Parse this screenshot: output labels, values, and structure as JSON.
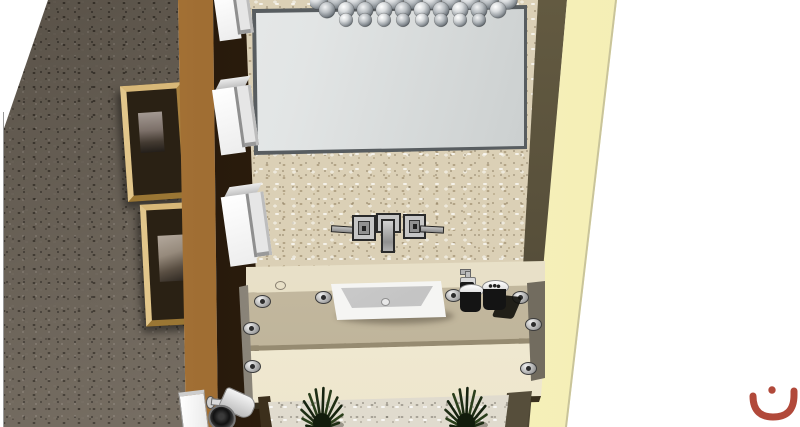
{
  "scene": {
    "type": "3d-interior-render",
    "description": "3D rendering of a powder-room vanity wall: frameless mirror with bubble chandelier, pebbled stone wall, wall-mounted faucet, white vessel sink on a floating stone counter, toiletry jars, white box sconces on a dark pilaster, two framed pictures on a dark textured wall, yellow accent wall on the right and spiky plants below",
    "watermark": {
      "glyph": "ن",
      "color": "#b1493a"
    },
    "palette": {
      "canvas": "#ffffff",
      "stone_wall": "#dbd0b6",
      "dark_textured_wall": "#6d6458",
      "wood_pilaster": "#9a6a32",
      "recess": "#2d1e0f",
      "accent_wall_yellow": "#f9f4c4",
      "side_return_olive": "#57503a",
      "counter": "#c6bca3",
      "apron": "#f2ecd8",
      "sink": "#f4f4f2",
      "chrome": "#b9b9b9",
      "mirror": "#c8cccc",
      "plant_green": "#22301a",
      "frame_wood": "#c9a55f"
    },
    "objects": {
      "mirror": "frameless rectangular mirror",
      "chandelier": "chrome bubble-sphere chandelier",
      "sconces": "3 white box wall sconces",
      "pictures": "2 wood-framed pictures",
      "faucet": "wall-mounted 3-piece faucet",
      "sink": "white rectangular vessel sink",
      "accessories": "pump bottle and 2 dark jars",
      "plants": "2 spiky green plants",
      "camera": "cylindrical wall-mounted downlight"
    }
  }
}
